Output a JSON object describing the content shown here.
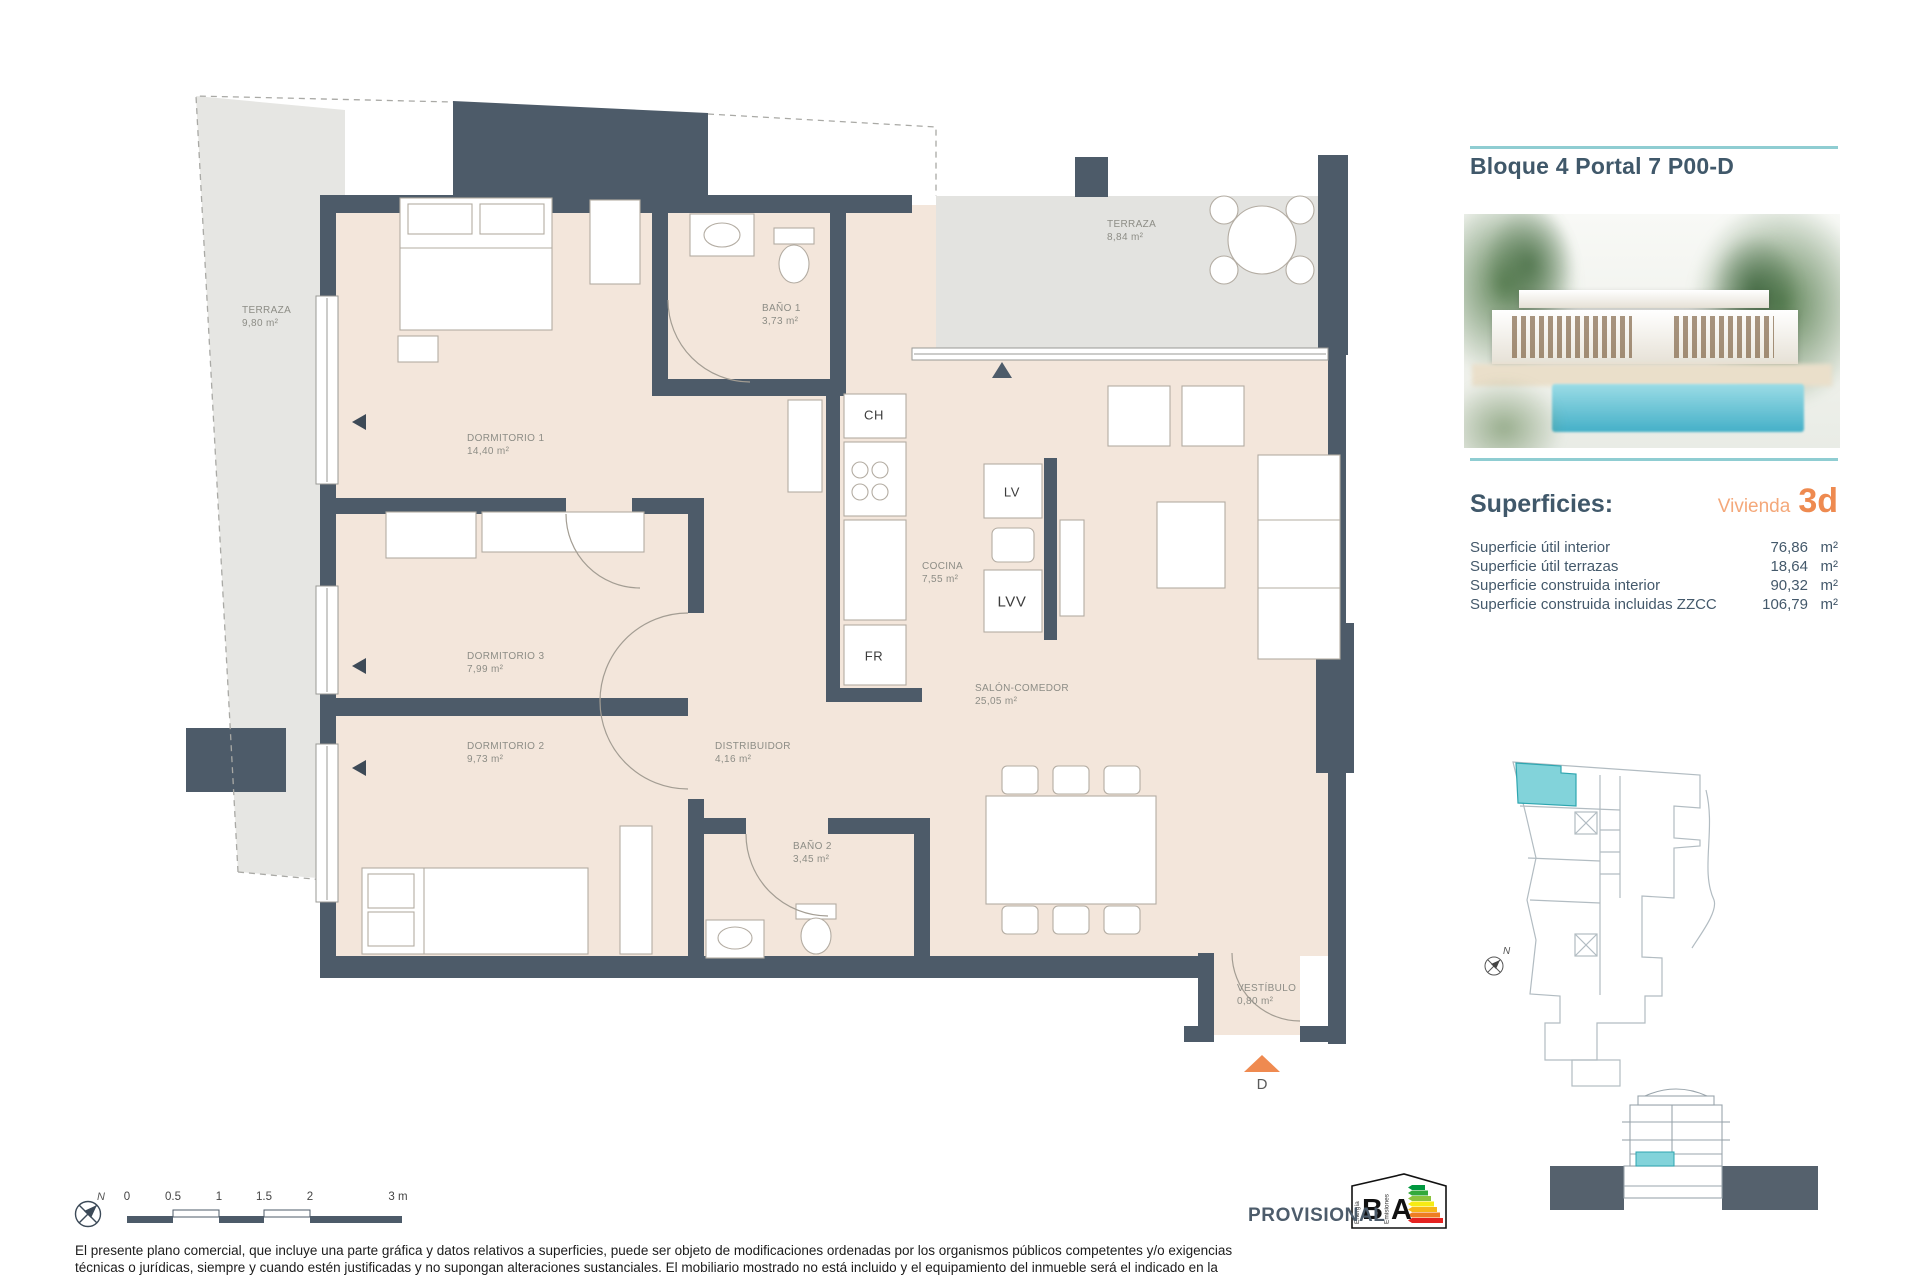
{
  "header": {
    "title": "Bloque 4 Portal 7 P00-D"
  },
  "superficies": {
    "heading": "Superficies:",
    "vivienda_label": "Vivienda",
    "vivienda_value": "3d",
    "rows": [
      {
        "label": "Superficie útil interior",
        "value": "76,86",
        "unit": "m²"
      },
      {
        "label": "Superficie útil terrazas",
        "value": "18,64",
        "unit": "m²"
      },
      {
        "label": "Superficie construida interior",
        "value": "90,32",
        "unit": "m²"
      },
      {
        "label": "Superficie construida incluidas ZZCC",
        "value": "106,79",
        "unit": "m²"
      }
    ]
  },
  "floorplan": {
    "rooms": [
      {
        "name": "TERRAZA",
        "area": "9,80 m²"
      },
      {
        "name": "DORMITORIO 1",
        "area": "14,40 m²"
      },
      {
        "name": "BAÑO 1",
        "area": "3,73 m²"
      },
      {
        "name": "TERRAZA",
        "area": "8,84 m²"
      },
      {
        "name": "COCINA",
        "area": "7,55 m²"
      },
      {
        "name": "DORMITORIO 3",
        "area": "7,99 m²"
      },
      {
        "name": "DORMITORIO 2",
        "area": "9,73 m²"
      },
      {
        "name": "DISTRIBUIDOR",
        "area": "4,16 m²"
      },
      {
        "name": "BAÑO 2",
        "area": "3,45 m²"
      },
      {
        "name": "SALÓN-COMEDOR",
        "area": "25,05 m²"
      },
      {
        "name": "VESTÍBULO",
        "area": "0,80 m²"
      }
    ],
    "appliances": {
      "ch": "CH",
      "lv": "LV",
      "lvv": "LVV",
      "fr": "FR"
    },
    "entrance_letter": "D",
    "north_letter": "N"
  },
  "scalebar": {
    "ticks": [
      "0",
      "0.5",
      "1",
      "1.5",
      "2",
      "3 m"
    ]
  },
  "footer": {
    "provisional": "PROVISIONAL",
    "energy": {
      "letter_b": "B",
      "letter_a": "A",
      "energia": "Energía",
      "emisiones": "Emisiones"
    },
    "disclaimer_line1": "El presente plano comercial, que incluye una parte gráfica y datos relativos a superficies, puede ser objeto de modificaciones ordenadas por los organismos públicos competentes y/o exigencias",
    "disclaimer_line2": "técnicas o jurídicas, siempre y cuando estén justificadas y no supongan alteraciones sustanciales. El mobiliario mostrado no está incluido y el equipamiento del inmueble será el indicado en la"
  },
  "colors": {
    "accent_teal": "#8fcdd2",
    "unit_highlight": "#7fd2d9",
    "title": "#40586a",
    "orange": "#ee8a50",
    "wall": "#4d5b69",
    "floor": "#f3e6db",
    "terrace": "#e6e6e3"
  }
}
